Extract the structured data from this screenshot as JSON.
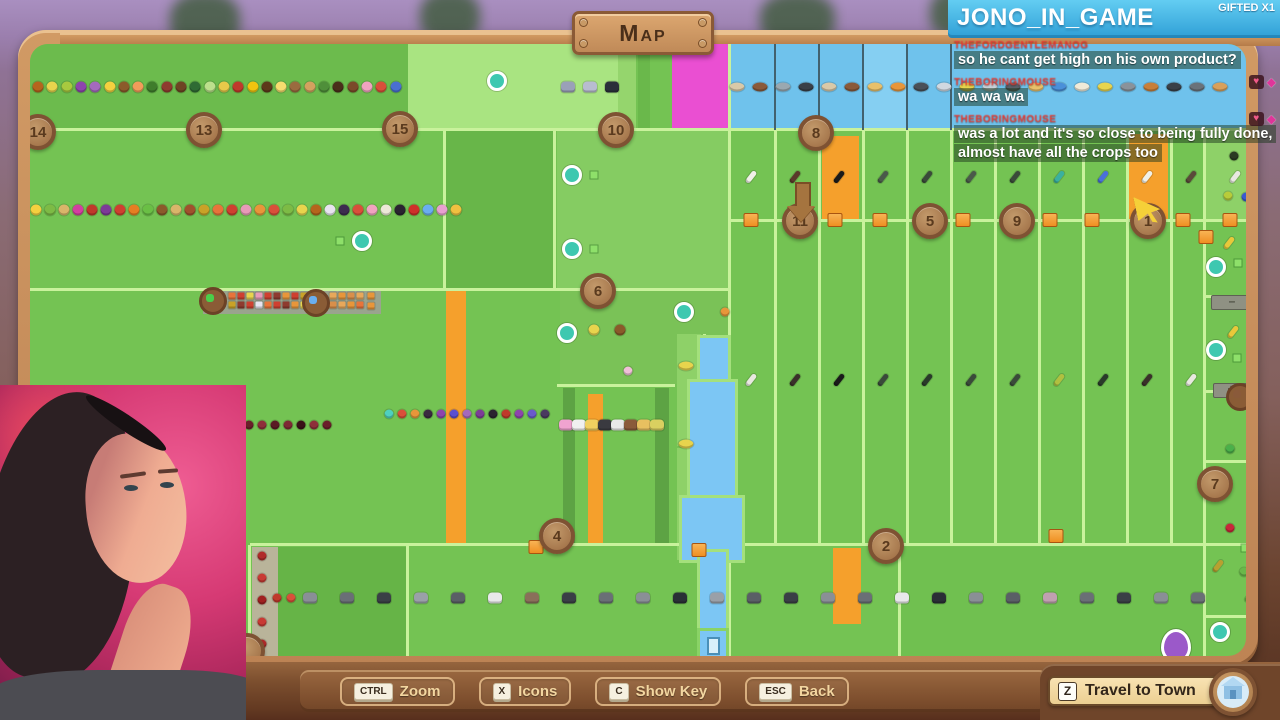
{
  "ui": {
    "map_title": "Map",
    "toolbar": {
      "buttons": [
        {
          "key": "CTRL",
          "label": "Zoom"
        },
        {
          "key": "X",
          "label": "Icons"
        },
        {
          "key": "C",
          "label": "Show Key"
        },
        {
          "key": "ESC",
          "label": "Back"
        }
      ]
    },
    "travel_button": {
      "key": "Z",
      "label": "Travel to Town",
      "icon": "town-house-icon"
    }
  },
  "chat": {
    "channel": "JONO_IN_GAME",
    "gifted_badge": "GIFTED X1",
    "accent_blue": "#3fb4e4",
    "username_color": "#e8382e",
    "messages": [
      {
        "user": "THEFORDGENTLEMANOG",
        "text": "so he cant get high on his own product?",
        "badges": []
      },
      {
        "user": "THEBORINGMOUSE",
        "text": "wa wa wa",
        "badges": [
          "heart",
          "gem"
        ]
      },
      {
        "user": "THEBORINGMOUSE",
        "text": "was a lot and it's so close to being fully done, almost have all the crops too",
        "badges": [
          "heart",
          "gem"
        ]
      }
    ]
  },
  "theme": {
    "wood": "#c08a5c",
    "map_base_green": "#74c353",
    "bright_line": "#c9f29c",
    "water_blue": "#7cc6f4",
    "pond_blue": "#6fc2ec",
    "magenta_plot": "#ea4fd2",
    "orange_plot": "#f5a02c",
    "marker_brown": "#9c6b42"
  },
  "map": {
    "plots": [
      {
        "x": 30,
        "y": 44,
        "w": 378,
        "h": 86,
        "c": "#6cbb4d",
        "dots": true
      },
      {
        "x": 408,
        "y": 44,
        "w": 210,
        "h": 86,
        "c": "#a9e481"
      },
      {
        "x": 618,
        "y": 44,
        "w": 18,
        "h": 86,
        "c": "#95d56d"
      },
      {
        "x": 638,
        "y": 44,
        "w": 12,
        "h": 86,
        "c": "#6ab84b"
      },
      {
        "x": 672,
        "y": 44,
        "w": 56,
        "h": 86,
        "c": "#ea4fd2"
      },
      {
        "x": 728,
        "y": 44,
        "w": 525,
        "h": 86,
        "c": "#6fc2ec"
      },
      {
        "x": 863,
        "y": 44,
        "w": 45,
        "h": 86,
        "c": "#85cff2",
        "dots": true
      },
      {
        "x": 445,
        "y": 131,
        "w": 110,
        "h": 158,
        "c": "#68b649",
        "dots": true
      },
      {
        "x": 557,
        "y": 131,
        "w": 172,
        "h": 158,
        "c": "#85cc62",
        "dots": true
      },
      {
        "x": 560,
        "y": 291,
        "w": 168,
        "h": 93,
        "c": "#7ac257",
        "dots": true
      },
      {
        "x": 1205,
        "y": 131,
        "w": 48,
        "h": 90,
        "c": "#8ed168"
      },
      {
        "x": 822,
        "y": 136,
        "w": 37,
        "h": 84,
        "c": "#f5a02c"
      },
      {
        "x": 1126,
        "y": 134,
        "w": 42,
        "h": 86,
        "c": "#f5a02c"
      },
      {
        "x": 446,
        "y": 291,
        "w": 20,
        "h": 253,
        "c": "#f5a02c"
      },
      {
        "x": 563,
        "y": 388,
        "w": 12,
        "h": 156,
        "c": "#5da344"
      },
      {
        "x": 655,
        "y": 388,
        "w": 14,
        "h": 156,
        "c": "#5da344"
      },
      {
        "x": 588,
        "y": 394,
        "w": 15,
        "h": 150,
        "c": "#f5a02c"
      },
      {
        "x": 833,
        "y": 548,
        "w": 28,
        "h": 76,
        "c": "#f5a02c"
      },
      {
        "x": 252,
        "y": 547,
        "w": 26,
        "h": 112,
        "c": "#b9b49a"
      },
      {
        "x": 278,
        "y": 547,
        "w": 128,
        "h": 112,
        "c": "#66b447",
        "dots": true
      },
      {
        "x": 900,
        "y": 547,
        "w": 303,
        "h": 112,
        "c": "#70c050",
        "dots": true
      },
      {
        "x": 677,
        "y": 334,
        "w": 24,
        "h": 112,
        "c": "#8ed168"
      },
      {
        "x": 677,
        "y": 448,
        "w": 24,
        "h": 112,
        "c": "#8ed168"
      },
      {
        "x": 203,
        "y": 289,
        "w": 178,
        "h": 25,
        "c": "#9aa48e"
      }
    ],
    "hlines": [
      {
        "x": 30,
        "y": 128,
        "w": 1223
      },
      {
        "x": 730,
        "y": 219,
        "w": 523
      },
      {
        "x": 30,
        "y": 288,
        "w": 700
      },
      {
        "x": 250,
        "y": 543,
        "w": 1003
      },
      {
        "x": 557,
        "y": 384,
        "w": 118
      },
      {
        "x": 1205,
        "y": 295,
        "w": 48
      },
      {
        "x": 1205,
        "y": 390,
        "w": 48
      },
      {
        "x": 1205,
        "y": 460,
        "w": 48
      },
      {
        "x": 1205,
        "y": 615,
        "w": 48
      }
    ],
    "vlines": [
      {
        "x": 443,
        "y": 131,
        "h": 158
      },
      {
        "x": 553,
        "y": 131,
        "h": 158
      },
      {
        "x": 728,
        "y": 44,
        "h": 616
      },
      {
        "x": 703,
        "y": 334,
        "h": 226
      },
      {
        "x": 248,
        "y": 545,
        "h": 114
      },
      {
        "x": 406,
        "y": 545,
        "h": 114
      },
      {
        "x": 898,
        "y": 545,
        "h": 114
      },
      {
        "x": 1203,
        "y": 131,
        "h": 529
      },
      {
        "x": 774,
        "y": 131,
        "h": 412
      },
      {
        "x": 818,
        "y": 131,
        "h": 412
      },
      {
        "x": 862,
        "y": 131,
        "h": 412
      },
      {
        "x": 906,
        "y": 131,
        "h": 412
      },
      {
        "x": 950,
        "y": 131,
        "h": 412
      },
      {
        "x": 994,
        "y": 131,
        "h": 412
      },
      {
        "x": 1038,
        "y": 131,
        "h": 412
      },
      {
        "x": 1082,
        "y": 131,
        "h": 412
      },
      {
        "x": 1126,
        "y": 131,
        "h": 412
      },
      {
        "x": 1170,
        "y": 131,
        "h": 412
      }
    ],
    "dklines": [
      {
        "x": 774,
        "y": 44,
        "h": 86
      },
      {
        "x": 818,
        "y": 44,
        "h": 86
      },
      {
        "x": 862,
        "y": 44,
        "h": 86
      },
      {
        "x": 906,
        "y": 44,
        "h": 86
      },
      {
        "x": 950,
        "y": 44,
        "h": 86
      }
    ],
    "river": [
      {
        "x": 700,
        "y": 338,
        "w": 28,
        "h": 55
      },
      {
        "x": 690,
        "y": 382,
        "w": 45,
        "h": 128
      },
      {
        "x": 682,
        "y": 498,
        "w": 60,
        "h": 62
      },
      {
        "x": 700,
        "y": 552,
        "w": 26,
        "h": 102
      }
    ],
    "dock": {
      "x": 697,
      "y": 628
    },
    "markers": [
      {
        "n": "14",
        "x": 38,
        "y": 132
      },
      {
        "n": "13",
        "x": 204,
        "y": 130
      },
      {
        "n": "15",
        "x": 400,
        "y": 129
      },
      {
        "n": "10",
        "x": 616,
        "y": 130
      },
      {
        "n": "8",
        "x": 816,
        "y": 133
      },
      {
        "n": "6",
        "x": 598,
        "y": 291
      },
      {
        "n": "11",
        "x": 800,
        "y": 221
      },
      {
        "n": "5",
        "x": 930,
        "y": 221
      },
      {
        "n": "9",
        "x": 1017,
        "y": 221
      },
      {
        "n": "1",
        "x": 1148,
        "y": 221
      },
      {
        "n": "4",
        "x": 557,
        "y": 536
      },
      {
        "n": "2",
        "x": 886,
        "y": 546
      },
      {
        "n": "7",
        "x": 1215,
        "y": 484
      },
      {
        "n": "",
        "x": 247,
        "y": 651
      }
    ],
    "icon_rows": [
      {
        "name": "fruit-row",
        "shape": "fruit",
        "x": 38,
        "y": 87,
        "gap": 14.3,
        "items": [
          "#b5651d",
          "#e8d44d",
          "#a8c93f",
          "#8e44ad",
          "#a569bd",
          "#f4d03f",
          "#8b5a2b",
          "#f39c5a",
          "#3f7d2c",
          "#8e3b2f",
          "#6e4423",
          "#2f6b34",
          "#bce08c",
          "#e8c94a",
          "#c0392b",
          "#f1c40f",
          "#5d3a1a",
          "#f7dc6f",
          "#9a6b3f",
          "#d3a15f",
          "#4f8f3a",
          "#4a2e1a",
          "#7b4a2a",
          "#f0a3c0",
          "#d94f3a",
          "#4a6fd0"
        ]
      },
      {
        "name": "fruit-row",
        "shape": "fruit",
        "x": 36,
        "y": 210,
        "gap": 14,
        "items": [
          "#f4d03f",
          "#7dbb45",
          "#d9b56a",
          "#d33fa0",
          "#c0392b",
          "#7d3c98",
          "#cf4030",
          "#e67e22",
          "#6abf45",
          "#8b5a2b",
          "#d9b56a",
          "#a0522d",
          "#c9a227",
          "#e8743a",
          "#cf4030",
          "#e89ab8",
          "#e8963a",
          "#d94f3a",
          "#7dbb45",
          "#e8d44d",
          "#b5651d",
          "#e8e4f0",
          "#3d2b4f",
          "#d94f3a",
          "#f0a3c0",
          "#ece8d8",
          "#2a2430",
          "#cf2f2a",
          "#6aaef0",
          "#e8a0d0",
          "#f0c040"
        ]
      },
      {
        "name": "fish-row",
        "shape": "fish",
        "x": 737,
        "y": 87,
        "gap": 23,
        "items": [
          "#d9c9a8",
          "#8a5a3a",
          "#9aa8b0",
          "#3a4048",
          "#d9c9a8",
          "#8a5a3a",
          "#e8c06a",
          "#e8963a",
          "#4a5058",
          "#d0d8e0",
          "#e8d44d",
          "#c8d0d8",
          "#5a6068",
          "#e8c06a",
          "#4a90d9",
          "#f0ead8",
          "#e8d44d",
          "#8a929a",
          "#c87f3a",
          "#3a4048",
          "#6a727a",
          "#d9a05a"
        ]
      },
      {
        "name": "bird-row",
        "shape": "animal",
        "x": 568,
        "y": 87,
        "gap": 22,
        "items": [
          "#9aa0b8",
          "#b8bcd0",
          "#2a2f3a"
        ]
      },
      {
        "name": "crop-glyph-row",
        "shape": "glyph",
        "x": 751,
        "y": 177,
        "gap": 44,
        "items": [
          "#f0f0e8",
          "#5a3a2a",
          "#1a1a1a",
          "#4a5a4a",
          "#3a4a3a",
          "#4a5a4a",
          "#3a4a3a",
          "#3ab0a0",
          "#4a70d9",
          "#f0f0e8",
          "#5a4a3a",
          "#e8e8e0"
        ]
      },
      {
        "name": "crop-glyph-row",
        "shape": "glyph",
        "x": 751,
        "y": 380,
        "gap": 44,
        "items": [
          "#e8e8e0",
          "#3a302a",
          "#1a1a1a",
          "#3a4a3a",
          "#2a3a2a",
          "#3a4a3a",
          "#3a4a3a",
          "#b0c040",
          "#2a3a2a",
          "#3a302a",
          "#e8e8e0"
        ]
      },
      {
        "name": "berry-row",
        "shape": "berry",
        "x": 389,
        "y": 414,
        "gap": 13,
        "items": [
          "#4fd0c0",
          "#d94f3a",
          "#e8963a",
          "#3a2a40",
          "#8e44ad",
          "#5a4fd0",
          "#a569bd",
          "#7d3c98",
          "#2a2430",
          "#c0392b",
          "#8e44ad",
          "#6a5acd",
          "#4a3a60"
        ]
      },
      {
        "name": "berry-row",
        "shape": "berry",
        "x": 249,
        "y": 425,
        "gap": 13,
        "items": [
          "#6a1f2a",
          "#8e2f3a",
          "#5a1a24",
          "#7d2a34",
          "#3a1218",
          "#8e2f3a",
          "#6a1f2a"
        ]
      },
      {
        "name": "duck-row",
        "shape": "animal",
        "x": 566,
        "y": 425,
        "gap": 13,
        "items": [
          "#f0a3d0",
          "#f0f0f0",
          "#f0d060",
          "#3a3a40",
          "#e8e8e8",
          "#8a5a3a",
          "#e8c060",
          "#d9d060"
        ]
      },
      {
        "name": "livestock-row",
        "shape": "animal",
        "x": 310,
        "y": 598,
        "gap": 37,
        "items": [
          "#8a8f96",
          "#6a6f76",
          "#3a3f46",
          "#9aa0a8",
          "#5a5f66",
          "#e8e8ea",
          "#8a6f5a",
          "#3a3f46",
          "#6a6f76",
          "#8a8f96",
          "#2a2f36",
          "#9aa0a8",
          "#5a5f66",
          "#3a3f46",
          "#8a8f96",
          "#6a6f76",
          "#e8e8ea",
          "#2a2f36",
          "#8a8f96",
          "#5a5f66",
          "#c0a0b0",
          "#6a6f76",
          "#3a3f46",
          "#8a8f96",
          "#6a6f76"
        ]
      },
      {
        "name": "berry-pair",
        "shape": "berry",
        "x": 277,
        "y": 598,
        "gap": 14,
        "items": [
          "#c0392b",
          "#d94f3a"
        ]
      },
      {
        "name": "strawberry-col",
        "shape": "berry",
        "x": 262,
        "y": 556,
        "gap": 22,
        "v": true,
        "items": [
          "#b02a2a",
          "#c83a34",
          "#a02020",
          "#c83a34",
          "#b02a2a"
        ]
      },
      {
        "name": "orchard-row",
        "shape": "fruit",
        "x": 568,
        "y": 330,
        "gap": 26,
        "items": [
          "#e8963a",
          "#e8d44d",
          "#8a5a2a"
        ]
      },
      {
        "name": "flower",
        "shape": "berry",
        "x": 628,
        "y": 371,
        "gap": 0,
        "items": [
          "#f0c0d8"
        ]
      },
      {
        "name": "pond-fish",
        "shape": "fish",
        "x": 686,
        "y": 366,
        "gap": 0,
        "items": [
          "#e8d44d"
        ]
      },
      {
        "name": "pond-fish",
        "shape": "fish",
        "x": 686,
        "y": 444,
        "gap": 0,
        "items": [
          "#e8d44d"
        ]
      },
      {
        "name": "shelf-fruit",
        "shape": "sq",
        "x": 232,
        "y": 296,
        "gap": 9,
        "items": [
          "#e8743a",
          "#cf4030",
          "#e8d44d",
          "#e89ab8",
          "#cf4030",
          "#8e3b2f",
          "#e8963a",
          "#cf4030",
          "#c9a227",
          "#e8743a"
        ]
      },
      {
        "name": "shelf-fruit",
        "shape": "sq",
        "x": 232,
        "y": 305,
        "gap": 9,
        "items": [
          "#c9a227",
          "#8e3b2f",
          "#cf4030",
          "#e8e4f0",
          "#e8743a",
          "#cf4030",
          "#8e3b2f",
          "#e8963a",
          "#e8d44d",
          "#c9a227"
        ]
      },
      {
        "name": "shelf-fruit",
        "shape": "sq",
        "x": 333,
        "y": 296,
        "gap": 9,
        "items": [
          "#e8a85a",
          "#e8963a",
          "#d98f4a",
          "#e8a85a"
        ]
      },
      {
        "name": "shelf-fruit",
        "shape": "sq",
        "x": 333,
        "y": 305,
        "gap": 9,
        "items": [
          "#d98f4a",
          "#e8a85a",
          "#e8963a",
          "#e8743a"
        ]
      },
      {
        "name": "sack-pair",
        "shape": "sq",
        "x": 371,
        "y": 296,
        "gap": 9,
        "items": [
          "#e8963a"
        ]
      },
      {
        "name": "sack-pair",
        "shape": "sq",
        "x": 371,
        "y": 306,
        "gap": 9,
        "items": [
          "#e8963a"
        ]
      },
      {
        "name": "edge-items",
        "shape": "berry",
        "x": 1234,
        "y": 156,
        "gap": 0,
        "items": [
          "#2a3a22"
        ]
      },
      {
        "name": "edge-items",
        "shape": "berry",
        "x": 1228,
        "y": 196,
        "gap": 0,
        "items": [
          "#b8cc3a"
        ]
      },
      {
        "name": "edge-items",
        "shape": "berry",
        "x": 1246,
        "y": 197,
        "gap": 0,
        "items": [
          "#3a5ad0"
        ]
      },
      {
        "name": "edge-items",
        "shape": "glyph",
        "x": 1229,
        "y": 243,
        "gap": 0,
        "items": [
          "#e8c83a"
        ]
      },
      {
        "name": "edge-items",
        "shape": "glyph",
        "x": 1233,
        "y": 332,
        "gap": 0,
        "items": [
          "#e8c83a"
        ]
      },
      {
        "name": "edge-items",
        "shape": "berry",
        "x": 1230,
        "y": 449,
        "gap": 0,
        "items": [
          "#4ab04a"
        ]
      },
      {
        "name": "edge-items",
        "shape": "berry",
        "x": 1230,
        "y": 528,
        "gap": 0,
        "items": [
          "#c8283a"
        ]
      },
      {
        "name": "edge-items",
        "shape": "glyph",
        "x": 1218,
        "y": 566,
        "gap": 0,
        "items": [
          "#b8a030"
        ]
      },
      {
        "name": "edge-items",
        "shape": "berry",
        "x": 1244,
        "y": 572,
        "gap": 0,
        "items": [
          "#6ab84a"
        ]
      },
      {
        "name": "edge-items",
        "shape": "glyph",
        "x": 1250,
        "y": 596,
        "gap": 0,
        "items": [
          "#6ab84a"
        ]
      },
      {
        "name": "edge-items",
        "shape": "berry",
        "x": 1251,
        "y": 650,
        "gap": 0,
        "items": [
          "#4ab04a"
        ]
      },
      {
        "name": "edge-items",
        "shape": "berry",
        "x": 725,
        "y": 312,
        "gap": 0,
        "items": [
          "#e8963a"
        ]
      }
    ],
    "rings": [
      {
        "x": 497,
        "y": 81
      },
      {
        "x": 572,
        "y": 175
      },
      {
        "x": 572,
        "y": 249
      },
      {
        "x": 362,
        "y": 241
      },
      {
        "x": 684,
        "y": 312
      },
      {
        "x": 567,
        "y": 333
      },
      {
        "x": 1216,
        "y": 267
      },
      {
        "x": 1216,
        "y": 350
      },
      {
        "x": 1220,
        "y": 632
      }
    ],
    "squares": [
      {
        "x": 594,
        "y": 175
      },
      {
        "x": 594,
        "y": 249
      },
      {
        "x": 340,
        "y": 241
      },
      {
        "x": 1238,
        "y": 263
      },
      {
        "x": 1237,
        "y": 358
      },
      {
        "x": 1245,
        "y": 548
      }
    ],
    "boxes": [
      {
        "x": 751,
        "y": 220
      },
      {
        "x": 835,
        "y": 220
      },
      {
        "x": 880,
        "y": 220
      },
      {
        "x": 963,
        "y": 220
      },
      {
        "x": 1050,
        "y": 220
      },
      {
        "x": 1092,
        "y": 220
      },
      {
        "x": 1183,
        "y": 220
      },
      {
        "x": 1230,
        "y": 220
      },
      {
        "x": 1206,
        "y": 237
      },
      {
        "x": 536,
        "y": 547
      },
      {
        "x": 699,
        "y": 550
      },
      {
        "x": 1056,
        "y": 536
      }
    ],
    "signs": [
      {
        "x": 1211,
        "y": 295,
        "w": 40,
        "t": "–"
      },
      {
        "x": 1213,
        "y": 383,
        "w": 34,
        "t": "+"
      }
    ],
    "pods": [
      {
        "x": 213,
        "y": 301,
        "inner": "#4acf4a"
      },
      {
        "x": 316,
        "y": 303,
        "inner": "#6aaef0"
      },
      {
        "x": 1240,
        "y": 397,
        "inner": "#8a5a3a"
      }
    ],
    "arrow": {
      "x": 795,
      "y": 182
    },
    "cursor": {
      "x": 1136,
      "y": 194
    },
    "balloon": {
      "x": 1176,
      "y": 646
    }
  }
}
